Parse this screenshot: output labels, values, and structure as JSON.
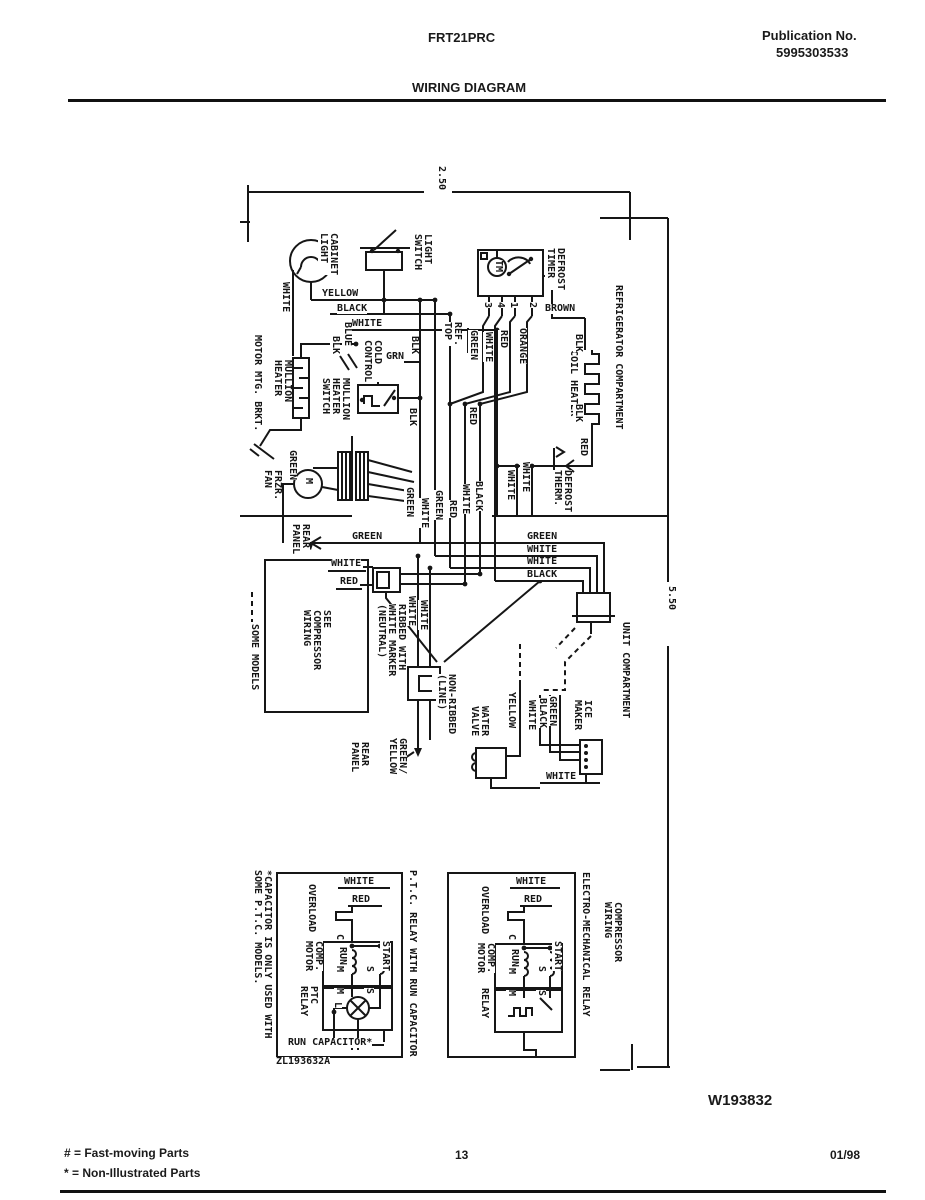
{
  "header": {
    "model": "FRT21PRC",
    "publication_label": "Publication No.",
    "publication_number": "5995303533",
    "title": "WIRING DIAGRAM"
  },
  "dims": {
    "top": "2.50",
    "side": "5.50"
  },
  "sections": {
    "refrigerator": "REFRIGERATOR COMPARTMENT",
    "unit": "UNIT COMPARTMENT"
  },
  "wires": {
    "yellow": "YELLOW",
    "black": "BLACK",
    "blk": "BLK",
    "white": "WHITE",
    "red": "RED",
    "green": "GREEN",
    "grn": "GRN",
    "blue": "BLUE",
    "brown": "BROWN",
    "orange": "ORANGE",
    "green_yellow": "GREEN/\nYELLOW"
  },
  "components": {
    "cabinet_light": "CABINET\nLIGHT",
    "light_switch": "LIGHT\nSWITCH",
    "defrost_timer": "DEFROST\nTIMER",
    "timer_motor": "TM",
    "ref_top": "REF.\nTOP",
    "cold_control": "COLD\nCONTROL",
    "mullion_heater": "MULLION\nHEATER",
    "mullion_heater_switch": "MULLION\nHEATER\nSWITCH",
    "motor_mtg_brkt": "MOTOR MTG. BRKT.",
    "frzr_fan": "FRZR.\nFAN",
    "coil_heater": "COIL HEATER",
    "defrost_therm": "DEFROST\nTHERM.",
    "rear_panel": "REAR\nPANEL",
    "see_compressor": "SEE\nCOMPRESSOR\nWIRING",
    "some_models": "SOME MODELS",
    "ribbed": "RIBBED WITH\nWHITE MARKER\n(NEUTRAL)",
    "non_ribbed": "NON-RIBBED\n(LINE)",
    "water_valve": "WATER\nVALVE",
    "ice_maker": "ICE\nMAKER",
    "overload": "OVERLOAD",
    "comp_motor": "COMP.\nMOTOR",
    "ptc_relay": "PTC\nRELAY",
    "relay": "RELAY",
    "run": "RUN",
    "start": "START",
    "run_capacitor": "RUN CAPACITOR*",
    "capacitor_note": "*CAPACITOR IS ONLY USED WITH\nSOME P.T.C. MODELS.",
    "ptc_caption": "P.T.C. RELAY WITH RUN CAPACITOR",
    "em_caption": "ELECTRO-MECHANICAL RELAY",
    "compressor_wiring": "COMPRESSOR\nWIRING",
    "diagram_code": "ZL193632A"
  },
  "terminals": {
    "c": "C",
    "m": "M",
    "s": "S",
    "l": "L",
    "t1": "1",
    "t2": "2",
    "t3": "3",
    "t4": "4"
  },
  "footer": {
    "doc_number": "W193832",
    "fast_moving": "# = Fast-moving Parts",
    "non_illustrated": "* = Non-Illustrated Parts",
    "page": "13",
    "date": "01/98"
  }
}
